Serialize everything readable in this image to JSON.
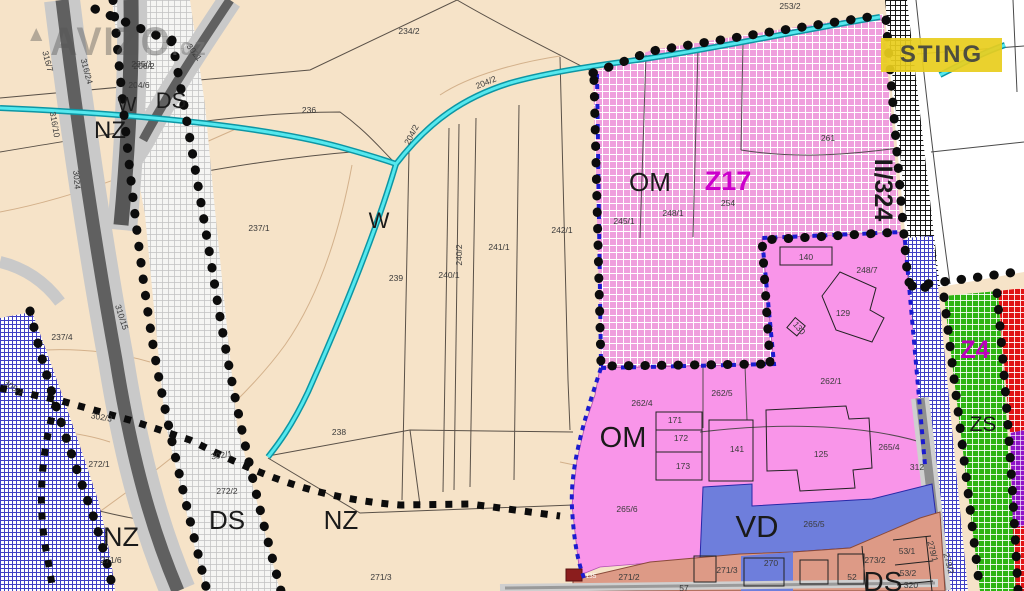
{
  "watermark": {
    "logo": "AVIZO",
    "suffix": ".cz",
    "triangle": "▲"
  },
  "badge": {
    "text": "STING"
  },
  "colors": {
    "beige_bg": "#f6e3c8",
    "pink_hatch": "#ef9fdd",
    "pink_solid": "#f995e9",
    "blue_vd": "#6e7edc",
    "salmon_residential": "#dd9a86",
    "green_zs": "#2eb412",
    "red_strip": "#e01414",
    "purple_strip": "#9014c8",
    "blue_hatch": "#4040c4",
    "stream_cyan": "#45dfe3",
    "road_light": "#c9c9c9",
    "road_dark": "#5a5a5a",
    "boundary_dots": "#0c0c0c",
    "om_border_blue": "#1c1ccf",
    "badge_bg": "#e8cd1e",
    "zone_label": "#1a1a1a",
    "parcel_label": "#3a3a3a",
    "z17_label": "#cc00cc",
    "dark_red_box": "#8b1d1d"
  },
  "zone_labels": [
    {
      "t": "W",
      "x": 127,
      "y": 111,
      "s": 20
    },
    {
      "t": "DS",
      "x": 171,
      "y": 108,
      "s": 22
    },
    {
      "t": "NZ",
      "x": 110,
      "y": 138,
      "s": 24
    },
    {
      "t": "W",
      "x": 379,
      "y": 228,
      "s": 22
    },
    {
      "t": "NZ",
      "x": 121,
      "y": 546,
      "s": 27
    },
    {
      "t": "DS",
      "x": 227,
      "y": 529,
      "s": 26
    },
    {
      "t": "NZ",
      "x": 341,
      "y": 529,
      "s": 26
    },
    {
      "t": "OM",
      "x": 650,
      "y": 191,
      "s": 26
    },
    {
      "t": "Z17",
      "x": 728,
      "y": 190,
      "s": 27,
      "c": "#cc00cc",
      "b": 1
    },
    {
      "t": "II/324",
      "x": 875,
      "y": 190,
      "s": 25,
      "r": 90,
      "b": 1
    },
    {
      "t": "OM",
      "x": 623,
      "y": 447,
      "s": 29
    },
    {
      "t": "VD",
      "x": 757,
      "y": 537,
      "s": 31
    },
    {
      "t": "DS",
      "x": 883,
      "y": 591,
      "s": 28
    },
    {
      "t": "ZS",
      "x": 983,
      "y": 431,
      "s": 21
    },
    {
      "t": "Z4",
      "x": 975,
      "y": 358,
      "s": 25,
      "c": "#bb00bb",
      "b": 1
    }
  ],
  "parcel_labels": [
    {
      "t": "234/2",
      "x": 409,
      "y": 34
    },
    {
      "t": "235/1",
      "x": 142,
      "y": 67
    },
    {
      "t": "236",
      "x": 309,
      "y": 113
    },
    {
      "t": "206/2",
      "x": 144,
      "y": 69
    },
    {
      "t": "204/6",
      "x": 139,
      "y": 88
    },
    {
      "t": "253/2",
      "x": 790,
      "y": 9
    },
    {
      "t": "237/1",
      "x": 259,
      "y": 231
    },
    {
      "t": "239",
      "x": 396,
      "y": 281
    },
    {
      "t": "240/1",
      "x": 449,
      "y": 278
    },
    {
      "t": "240/2",
      "x": 462,
      "y": 255,
      "r": -90
    },
    {
      "t": "241/1",
      "x": 499,
      "y": 250
    },
    {
      "t": "242/1",
      "x": 562,
      "y": 233
    },
    {
      "t": "245/1",
      "x": 624,
      "y": 224
    },
    {
      "t": "248/1",
      "x": 673,
      "y": 216
    },
    {
      "t": "254",
      "x": 728,
      "y": 206
    },
    {
      "t": "261",
      "x": 828,
      "y": 141
    },
    {
      "t": "140",
      "x": 806,
      "y": 260
    },
    {
      "t": "248/7",
      "x": 867,
      "y": 273
    },
    {
      "t": "129",
      "x": 843,
      "y": 316
    },
    {
      "t": "130",
      "x": 797,
      "y": 330,
      "r": 50
    },
    {
      "t": "204/2",
      "x": 487,
      "y": 85,
      "r": -22
    },
    {
      "t": "204/2",
      "x": 414,
      "y": 136,
      "r": -62
    },
    {
      "t": "3021",
      "x": 192,
      "y": 54,
      "r": 52
    },
    {
      "t": "316/7",
      "x": 45,
      "y": 62,
      "r": 75
    },
    {
      "t": "316/24",
      "x": 84,
      "y": 72,
      "r": 75
    },
    {
      "t": "316/10",
      "x": 52,
      "y": 125,
      "r": 80
    },
    {
      "t": "3024",
      "x": 74,
      "y": 180,
      "r": 85
    },
    {
      "t": "310/15",
      "x": 119,
      "y": 318,
      "r": 72
    },
    {
      "t": "237/4",
      "x": 62,
      "y": 340
    },
    {
      "t": "305/7",
      "x": 12,
      "y": 390,
      "r": 35
    },
    {
      "t": "302/3",
      "x": 101,
      "y": 420,
      "r": 10
    },
    {
      "t": "272/1",
      "x": 99,
      "y": 467
    },
    {
      "t": "272/2",
      "x": 227,
      "y": 494
    },
    {
      "t": "302/1",
      "x": 222,
      "y": 458,
      "r": -8
    },
    {
      "t": "271/6",
      "x": 111,
      "y": 563
    },
    {
      "t": "238",
      "x": 339,
      "y": 435
    },
    {
      "t": "271/3",
      "x": 381,
      "y": 580
    },
    {
      "t": "262/4",
      "x": 642,
      "y": 406
    },
    {
      "t": "262/5",
      "x": 722,
      "y": 396
    },
    {
      "t": "262/1",
      "x": 831,
      "y": 384
    },
    {
      "t": "171",
      "x": 675,
      "y": 423
    },
    {
      "t": "172",
      "x": 681,
      "y": 441
    },
    {
      "t": "173",
      "x": 683,
      "y": 469
    },
    {
      "t": "141",
      "x": 737,
      "y": 452
    },
    {
      "t": "125",
      "x": 821,
      "y": 457
    },
    {
      "t": "265/4",
      "x": 889,
      "y": 450
    },
    {
      "t": "312",
      "x": 917,
      "y": 470
    },
    {
      "t": "265/6",
      "x": 627,
      "y": 512
    },
    {
      "t": "265/5",
      "x": 814,
      "y": 527
    },
    {
      "t": "135",
      "x": 591,
      "y": 578,
      "s": 6.5,
      "c": "#ffffff"
    },
    {
      "t": "271/2",
      "x": 629,
      "y": 580
    },
    {
      "t": "271/3",
      "x": 727,
      "y": 573
    },
    {
      "t": "270",
      "x": 771,
      "y": 566
    },
    {
      "t": "52",
      "x": 852,
      "y": 580
    },
    {
      "t": "57",
      "x": 684,
      "y": 591
    },
    {
      "t": "273/2",
      "x": 875,
      "y": 563
    },
    {
      "t": "53/1",
      "x": 907,
      "y": 554
    },
    {
      "t": "53/2",
      "x": 908,
      "y": 576
    },
    {
      "t": "320",
      "x": 911,
      "y": 588
    },
    {
      "t": "279/1",
      "x": 930,
      "y": 552,
      "r": 75
    },
    {
      "t": "279/2",
      "x": 946,
      "y": 564,
      "r": 75
    }
  ]
}
